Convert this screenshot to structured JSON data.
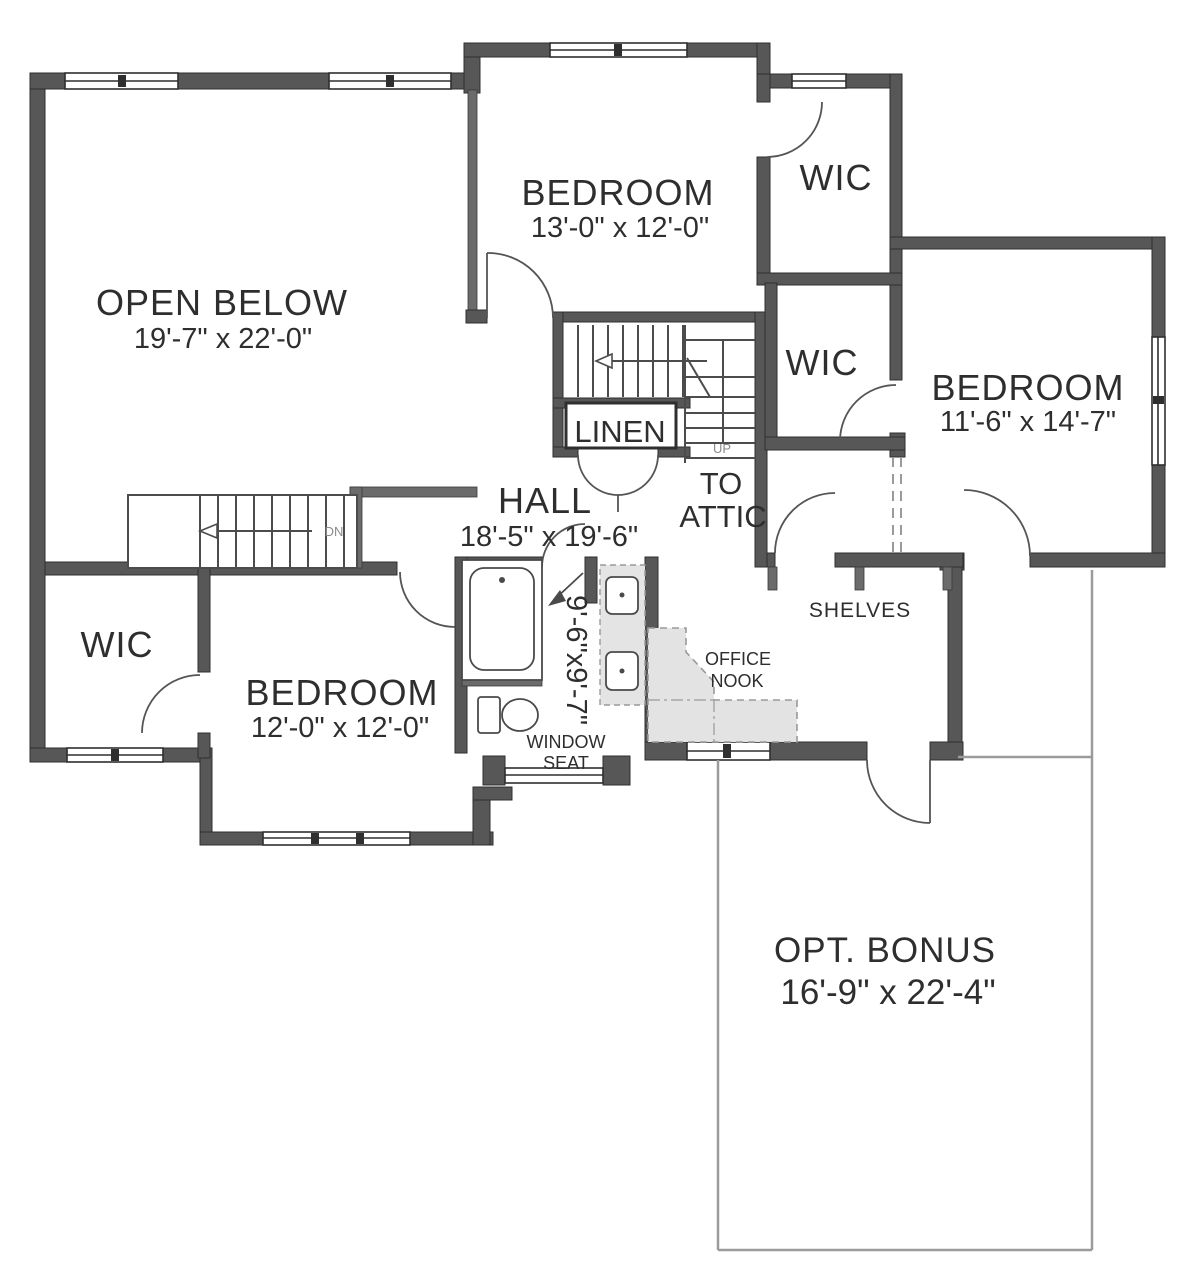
{
  "plan": {
    "rooms": {
      "open_below": {
        "name": "OPEN BELOW",
        "dims": "19'-7\" x 22'-0\""
      },
      "bedroom_top": {
        "name": "BEDROOM",
        "dims": "13'-0\" x 12'-0\""
      },
      "bedroom_right": {
        "name": "BEDROOM",
        "dims": "11'-6\" x 14'-7\""
      },
      "bedroom_bottom": {
        "name": "BEDROOM",
        "dims": "12'-0\" x 12'-0\""
      },
      "hall": {
        "name": "HALL",
        "dims": "18'-5\" x 19'-6\""
      },
      "opt_bonus": {
        "name": "OPT. BONUS",
        "dims": "16'-9\" x 22'-4\""
      },
      "wic_top": {
        "name": "WIC"
      },
      "wic_mid": {
        "name": "WIC"
      },
      "wic_left": {
        "name": "WIC"
      },
      "linen": {
        "name": "LINEN"
      },
      "bath": {
        "dims": "9'-6\"x9'-7\""
      }
    },
    "labels": {
      "to_attic_line1": "TO",
      "to_attic_line2": "ATTIC",
      "up": "UP",
      "dn": "DN",
      "shelves": "SHELVES",
      "office_line1": "OFFICE",
      "office_line2": "NOOK",
      "window_seat_line1": "WINDOW",
      "window_seat_line2": "SEAT"
    },
    "colors": {
      "wall": "#575757",
      "wall_edge": "#2f2f2f",
      "text": "#2e2e2e",
      "muted_label": "#8a8a8a",
      "counter_fill": "#e4e4e4",
      "bonus_outline": "#9b9b9b",
      "background": "#ffffff"
    }
  }
}
